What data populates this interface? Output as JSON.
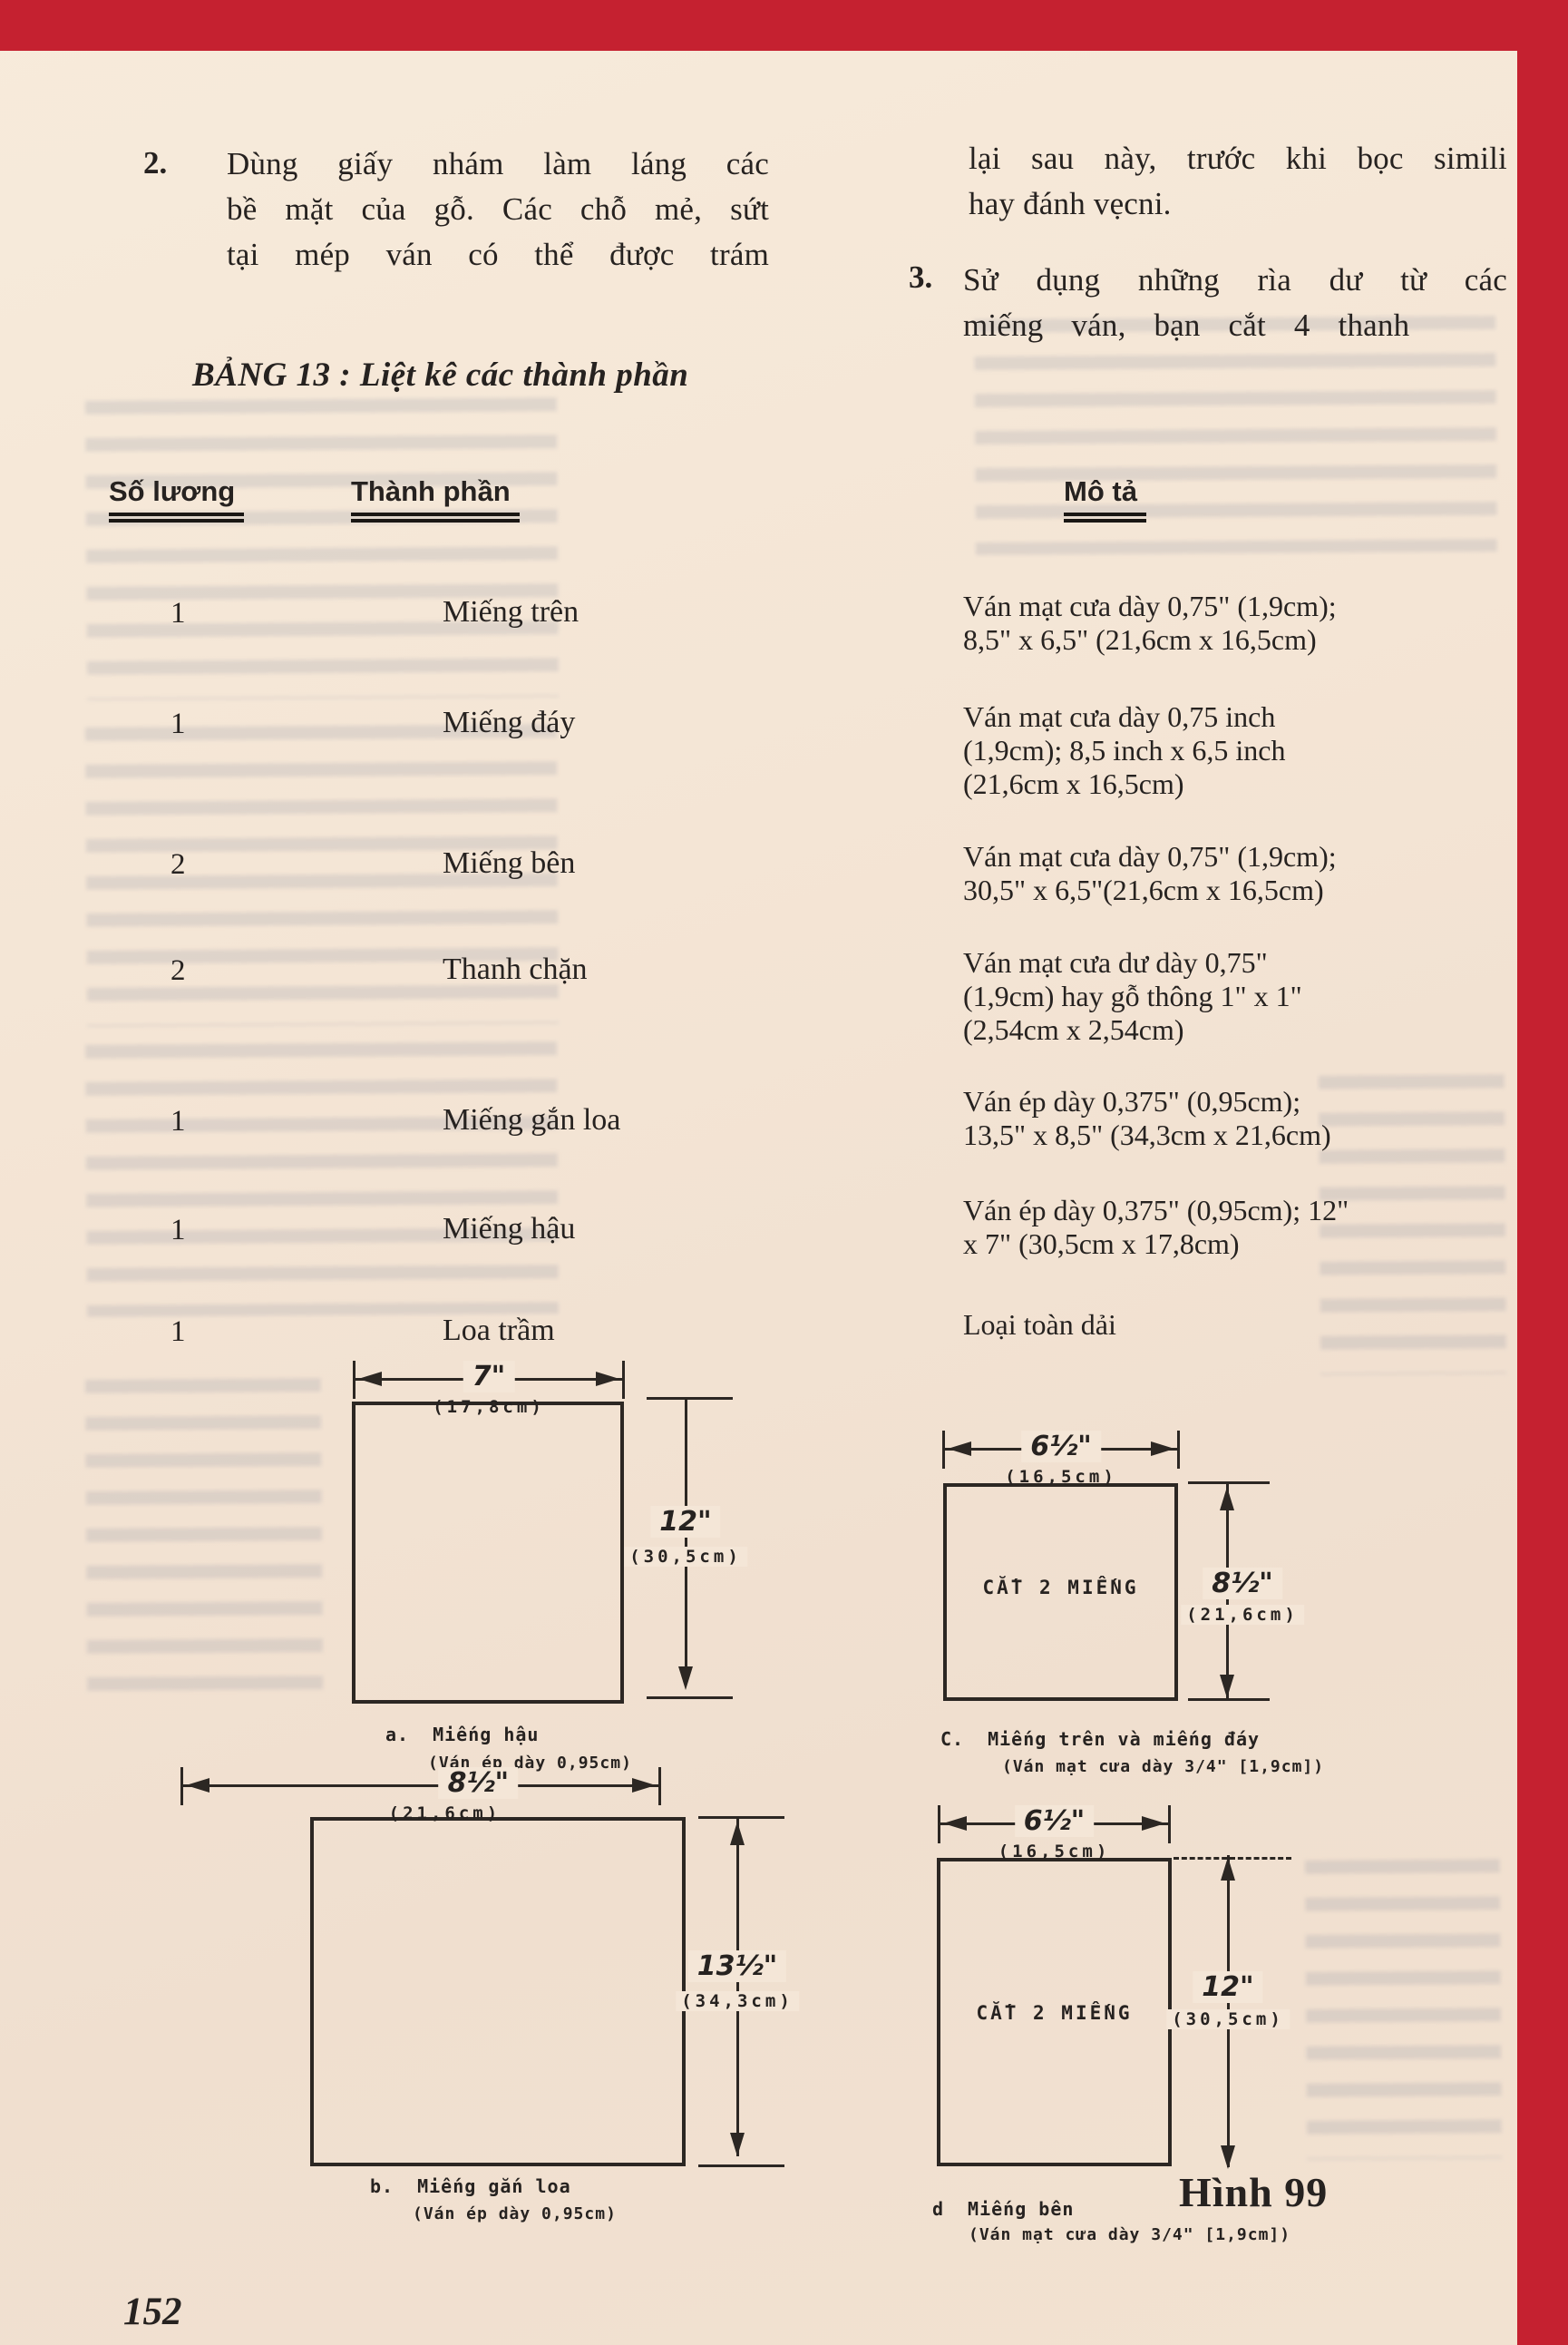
{
  "page": {
    "number": "152",
    "figure_caption": "Hình 99",
    "accent_color": "#c52130"
  },
  "intro": {
    "item2_no": "2.",
    "item2_lines": [
      "Dùng giấy nhám làm láng các",
      "bề mặt của gỗ. Các chỗ mẻ, sứt",
      "tại mép ván có thể được trám"
    ],
    "cont_lines": [
      "lại sau này, trước khi bọc simili",
      "hay đánh vẹcni."
    ],
    "item3_no": "3.",
    "item3_lines": [
      "Sử dụng những rìa dư từ các",
      "miếng ván, bạn cắt 4 thanh"
    ]
  },
  "table": {
    "title": "BẢNG 13 : Liệt kê các thành phần",
    "headers": {
      "quantity": "Số lương",
      "component": "Thành phần",
      "description": "Mô tả"
    },
    "rows": [
      {
        "qty": "1",
        "component": "Miếng trên",
        "description": "Ván mạt cưa dày 0,75\" (1,9cm);\n8,5\" x 6,5\" (21,6cm x 16,5cm)"
      },
      {
        "qty": "1",
        "component": "Miếng đáy",
        "description": "Ván mạt cưa dày 0,75 inch\n(1,9cm); 8,5 inch x 6,5 inch\n(21,6cm x 16,5cm)"
      },
      {
        "qty": "2",
        "component": "Miếng bên",
        "description": "Ván mạt cưa dày 0,75\" (1,9cm);\n30,5\" x 6,5\"(21,6cm x 16,5cm)"
      },
      {
        "qty": "2",
        "component": "Thanh chặn",
        "description": "Ván mạt cưa dư dày 0,75\"\n(1,9cm) hay gỗ thông 1\" x 1\"\n(2,54cm x 2,54cm)"
      },
      {
        "qty": "1",
        "component": "Miếng gắn loa",
        "description": "Ván ép dày 0,375\" (0,95cm);\n13,5\" x 8,5\" (34,3cm x 21,6cm)"
      },
      {
        "qty": "1",
        "component": "Miếng hậu",
        "description": "Ván ép dày 0,375\" (0,95cm); 12\"\nx 7\" (30,5cm x 17,8cm)"
      },
      {
        "qty": "1",
        "component": "Loa trầm",
        "description": "Loại toàn dải"
      }
    ]
  },
  "diagrams": {
    "a": {
      "label": "a.",
      "name": "Miếng hậu",
      "material": "(Ván ép dày 0,95cm)",
      "width_in": "7\"",
      "width_cm": "(17,8cm)",
      "height_in": "12\"",
      "height_cm": "(30,5cm)"
    },
    "b": {
      "label": "b.",
      "name": "Miếng gắn loa",
      "material": "(Ván ép dày 0,95cm)",
      "width_in": "8½\"",
      "width_cm": "(21,6cm)",
      "height_in": "13½\"",
      "height_cm": "(34,3cm)"
    },
    "c": {
      "label": "C.",
      "name": "Miếng trên và miếng đáy",
      "material": "(Ván mạt cưa dày 3/4\" [1,9cm])",
      "cut_note": "CẮT 2 MIẾNG",
      "width_in": "6½\"",
      "width_cm": "(16,5cm)",
      "height_in": "8½\"",
      "height_cm": "(21,6cm)"
    },
    "d": {
      "label": "d",
      "name": "Miếng bên",
      "material": "(Ván mạt cưa dày 3/4\" [1,9cm])",
      "cut_note": "CẮT 2 MIẾNG",
      "width_in": "6½\"",
      "width_cm": "(16,5cm)",
      "height_in": "12\"",
      "height_cm": "(30,5cm)"
    }
  }
}
